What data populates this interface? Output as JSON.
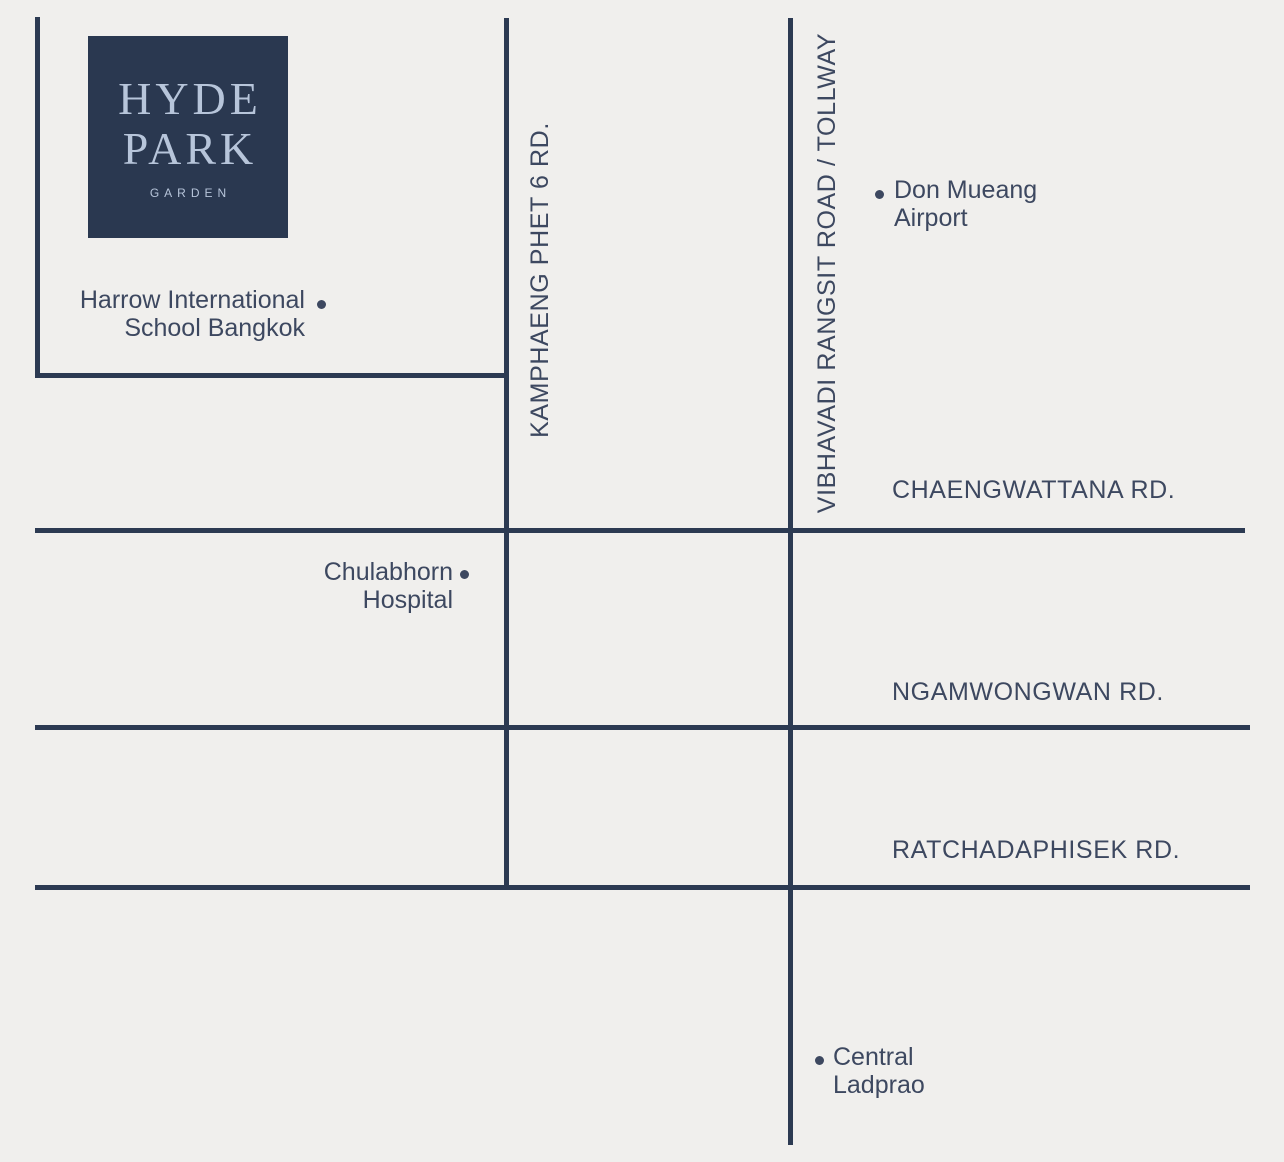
{
  "title": "Hyde Park Garden location map",
  "colors": {
    "background": "#f0efed",
    "road": "#2c3a52",
    "text": "#3d4860",
    "logo_background": "#2a3850",
    "logo_text": "#b7c5da"
  },
  "logo": {
    "line1": "HYDE",
    "line2": "PARK",
    "subtitle": "GARDEN"
  },
  "roads": {
    "kamphaeng": {
      "label": "KAMPHAENG PHET 6 RD."
    },
    "vibhavadi": {
      "label": "VIBHAVADI RANGSIT ROAD / TOLLWAY"
    },
    "chaengwattana": {
      "label": "CHAENGWATTANA RD."
    },
    "ngamwongwan": {
      "label": "NGAMWONGWAN RD."
    },
    "ratchadaphisek": {
      "label": "RATCHADAPHISEK RD."
    }
  },
  "landmarks": {
    "harrow": {
      "line1": "Harrow International",
      "line2": "School Bangkok"
    },
    "chulabhorn": {
      "line1": "Chulabhorn",
      "line2": "Hospital"
    },
    "don_mueang": {
      "line1": "Don Mueang",
      "line2": "Airport"
    },
    "central_ladprao": {
      "line1": "Central",
      "line2": "Ladprao"
    }
  }
}
